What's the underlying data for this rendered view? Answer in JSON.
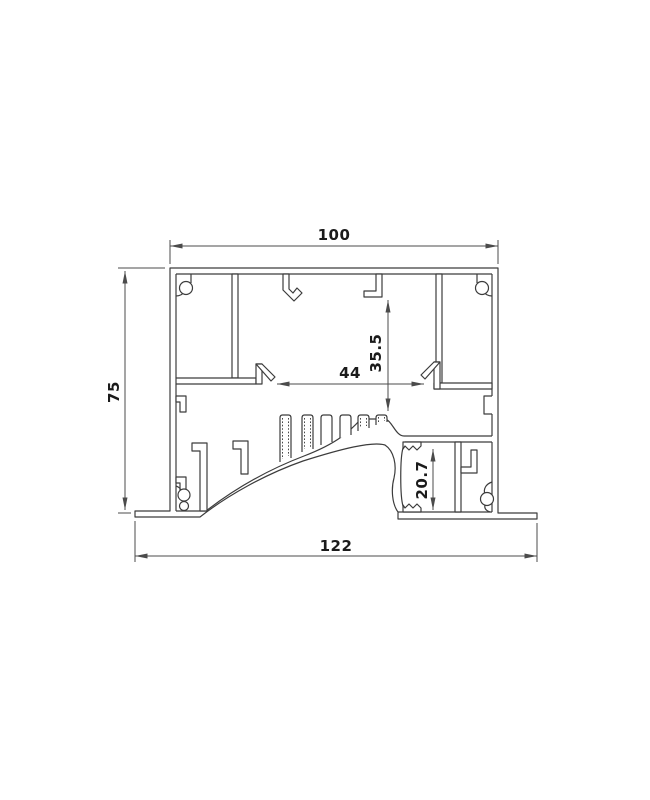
{
  "drawing": {
    "title": "aluminium-profile-cross-section",
    "dimensions": {
      "overall_top_width": "100",
      "left_height": "75",
      "overall_bottom_width": "122",
      "inner_slot_width": "44",
      "inner_depth": "35.5",
      "pocket_height": "20.7"
    },
    "colors": {
      "background": "#ffffff",
      "profile_line": "#3c3c3c",
      "dimension_line": "#4b4b4b",
      "dimension_text": "#1b1b1b"
    }
  }
}
